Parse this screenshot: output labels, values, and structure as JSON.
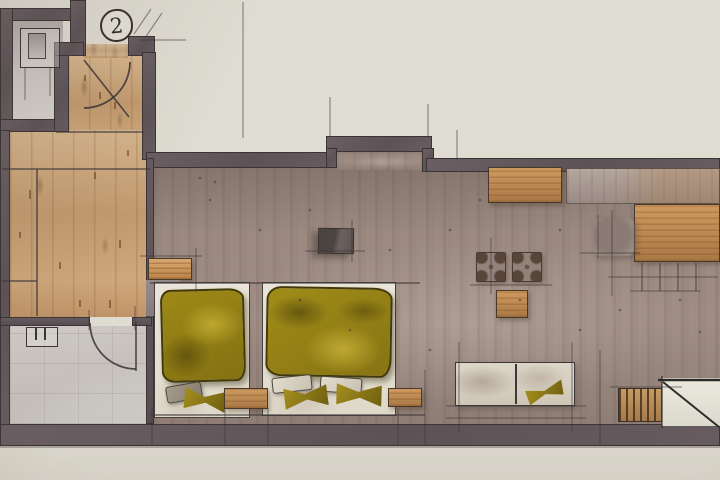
{
  "plan": {
    "room_number_label": "2"
  },
  "palette": {
    "paper": "#dfdcd1",
    "wall": "#5d5357",
    "wall_outline": "#3b3436",
    "wood_floor": "#c8a57c",
    "wood_furniture": "#b9834b",
    "main_floor": "#a29087",
    "bath_floor": "#cbc7c2",
    "bed_olive": "#968113",
    "bed_olive_dark": "#5c500f",
    "linen": "#e8e3d6",
    "sofa_fabric": "#d6cfc2",
    "ink": "#3a3335"
  }
}
